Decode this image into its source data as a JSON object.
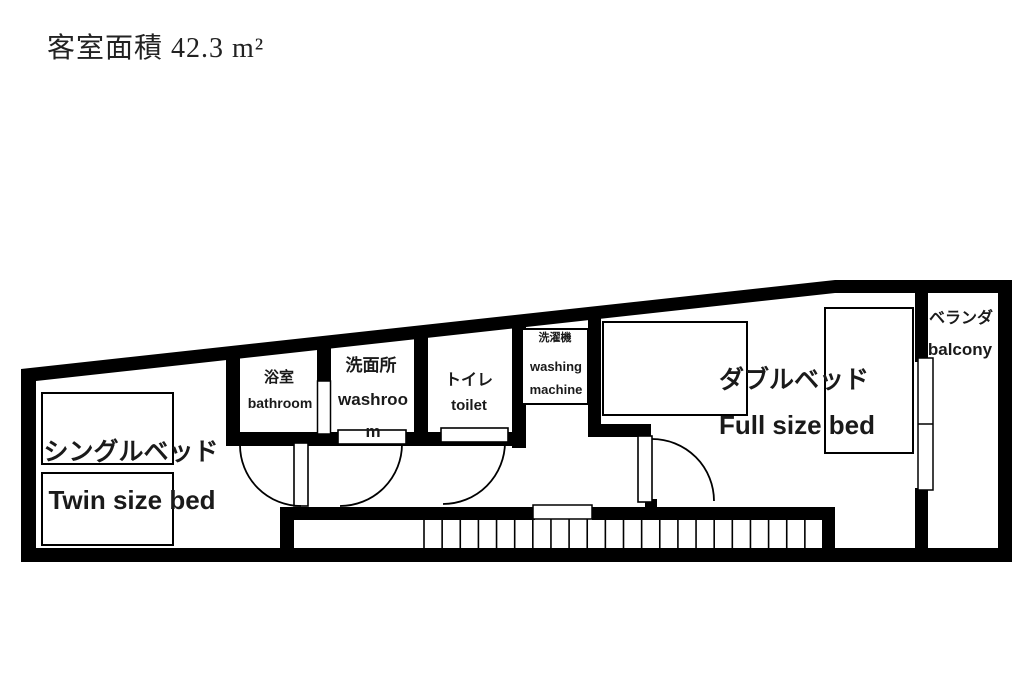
{
  "title": "客室面積 42.3 m²",
  "rooms": {
    "bathroom": {
      "jp": "浴室",
      "en": "bathroom"
    },
    "washroom": {
      "jp": "洗面所",
      "en": "washroom"
    },
    "toilet": {
      "jp": "トイレ",
      "en": "toilet"
    },
    "washing_machine": {
      "jp": "洗濯機",
      "en": "washing machine"
    },
    "single_bed": {
      "jp": "シングルベッド",
      "en": "Twin size bed"
    },
    "double_bed": {
      "jp": "ダブルベッド",
      "en": "Full size bed"
    },
    "balcony": {
      "jp": "ベランダ",
      "en": "balcony"
    }
  },
  "stairs": {
    "x_start": 424,
    "x_end": 823,
    "step_count": 22,
    "y_top": 519,
    "y_bottom": 548
  },
  "colors": {
    "wall": "#000000",
    "floor": "#ffffff",
    "text": "#1a1a1a"
  }
}
